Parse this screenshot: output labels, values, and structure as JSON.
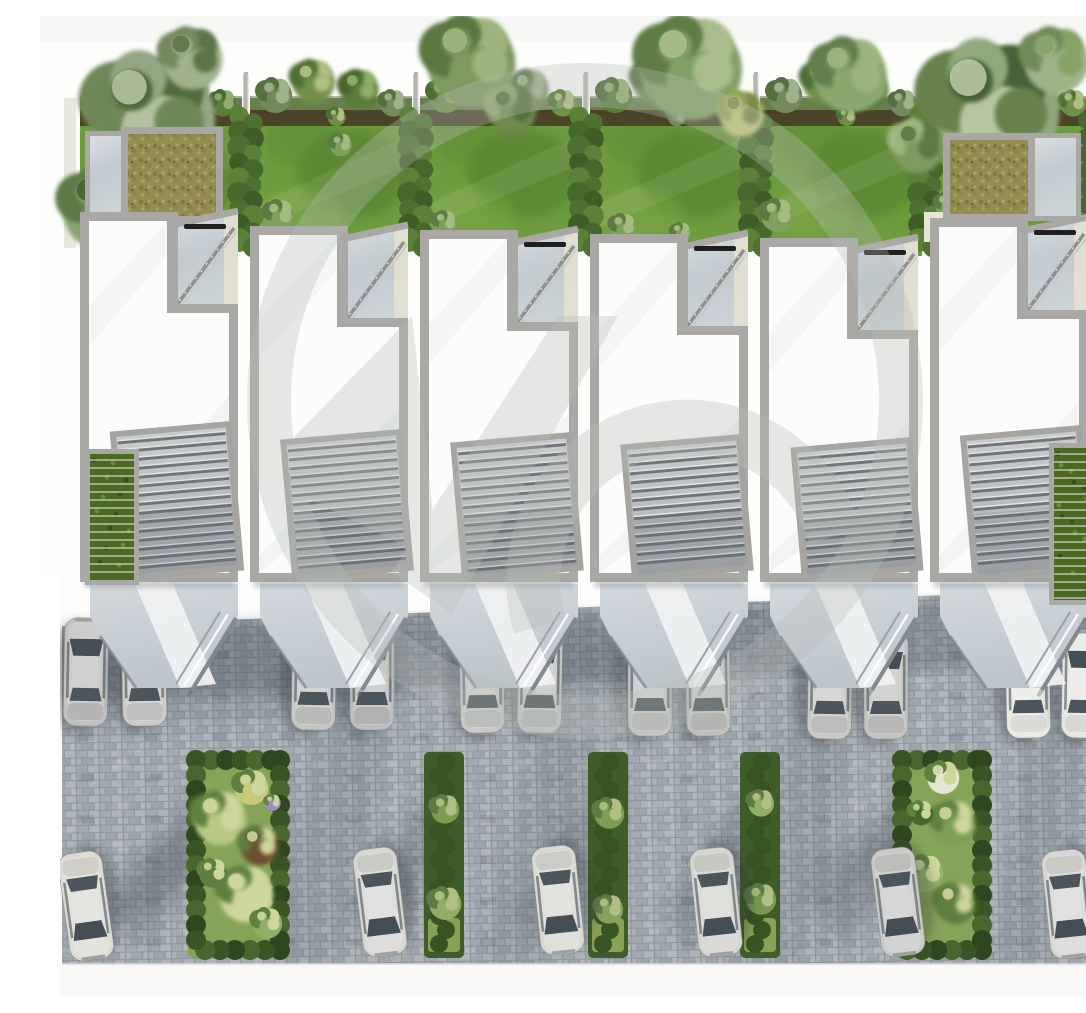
{
  "scene": {
    "description": "Aerial top-down 3D architectural rendering of six modern terraced townhouses with private rear gardens and hedges at the top, white roofs with roof terraces and louvered pergolas in the middle, and a block-paved parking court with parked cars and planted islands at the bottom; a light gray circular logo watermark overlays the center.",
    "canvas": {
      "width": 1086,
      "height": 981,
      "background": "#fdfdfc",
      "top_band": "#f6f7f5",
      "bottom_band": "#f8f8f6"
    },
    "palette": {
      "lawn": "#6d9b3d",
      "lawn_dark": "#4f7a2c",
      "lawn_light": "#84ad4d",
      "hedge_dark": "#3f5e27",
      "hedge_mid": "#4e7030",
      "hedge_light": "#5b8038",
      "mulch": "#463524",
      "top_wall": "#63635e",
      "parapet": "#a9a8a5",
      "roof_white": "#fbfcfc",
      "roof_shade": "#e8ebe9",
      "louver_panel": "#c3c6c7",
      "louver_slat": "#70757a",
      "louver_frame": "#a5a4a1",
      "marble_light": "#d9dee1",
      "marble_mid": "#c2cacf",
      "court": "#cbd2d7",
      "walkway": "#eef0f1",
      "paver": "#a9b0b6",
      "paver_dark": "#9ca4ac",
      "paver_light": "#b2b8be",
      "paver_joint": "#8f969d",
      "shade": "#323b46",
      "beige": "#e8e5d4",
      "beige_wall": "#e3e0d0",
      "pale_wall": "#e9e8de",
      "sedum_base": "#9b9055",
      "sedum_dark": "#7a7c42",
      "sedum_light": "#b4aa67",
      "green_wall": "#4a6a22",
      "glass_dark": "#454e54",
      "glass_rear": "#4c555b",
      "watermark": "#b9beb8"
    },
    "units": {
      "count": 6,
      "x_starts": [
        36,
        206,
        376,
        546,
        716,
        886
      ],
      "width": 170,
      "top_offsets": [
        0,
        14,
        18,
        22,
        26,
        6
      ],
      "roof_top": 196,
      "roof_bottom": 566,
      "vent_units": [
        0,
        2,
        3,
        4,
        5
      ]
    },
    "gardens": {
      "top": 82,
      "fence_xs": [
        206,
        376,
        546,
        716,
        886
      ],
      "right_wall_x": 1052,
      "shrub_spots": [
        [
          28,
          78,
          17
        ],
        [
          66,
          64,
          21
        ],
        [
          112,
          72,
          19
        ],
        [
          146,
          86,
          13
        ],
        [
          90,
          100,
          9
        ]
      ],
      "inner_bushes": [
        [
          238,
          198,
          15
        ],
        [
          300,
          128,
          11
        ],
        [
          404,
          206,
          12
        ],
        [
          582,
          210,
          13
        ],
        [
          640,
          216,
          10
        ],
        [
          736,
          198,
          16
        ],
        [
          906,
          188,
          12
        ]
      ]
    },
    "trees": [
      {
        "x": 108,
        "y": 96,
        "r": 62,
        "c": [
          "#93a683",
          "#6e8758",
          "#4f6a3c",
          "#b3c1a0"
        ]
      },
      {
        "x": 60,
        "y": 190,
        "r": 40,
        "c": [
          "#8ba272",
          "#5d7a44",
          "#42612f"
        ]
      },
      {
        "x": 150,
        "y": 40,
        "r": 30,
        "c": [
          "#9fb18d",
          "#74895c",
          "#5c7547"
        ]
      },
      {
        "x": 428,
        "y": 42,
        "r": 44,
        "c": [
          "#7e9a60",
          "#5a7840",
          "#9eb47e"
        ]
      },
      {
        "x": 470,
        "y": 92,
        "r": 24,
        "c": [
          "#6d8a50",
          "#8fa871",
          "#546e3c"
        ]
      },
      {
        "x": 648,
        "y": 48,
        "r": 50,
        "c": [
          "#83a066",
          "#5f7d45",
          "#a9bd8c"
        ]
      },
      {
        "x": 700,
        "y": 96,
        "r": 22,
        "c": [
          "#c3c97a",
          "#97a45c",
          "#7c8a46"
        ]
      },
      {
        "x": 808,
        "y": 56,
        "r": 36,
        "c": [
          "#8aa86e",
          "#647f4e",
          "#9eb47e"
        ]
      },
      {
        "x": 948,
        "y": 88,
        "r": 66,
        "c": [
          "#90a87d",
          "#67814e",
          "#47623a",
          "#b7c6a2"
        ]
      },
      {
        "x": 1014,
        "y": 42,
        "r": 32,
        "c": [
          "#9eb488",
          "#708b58",
          "#86a368"
        ]
      },
      {
        "x": 876,
        "y": 128,
        "r": 26,
        "c": [
          "#7d9a60",
          "#9db77f",
          "#5c7a42"
        ]
      },
      {
        "x": 996,
        "y": 150,
        "r": 22,
        "c": [
          "#86a368",
          "#aabc84",
          "#647f4e"
        ]
      }
    ],
    "roof_structures": {
      "sedum_boxes": [
        {
          "x": 88,
          "y": 118,
          "w": 88,
          "h": 82
        },
        {
          "x": 910,
          "y": 124,
          "w": 78,
          "h": 74
        }
      ],
      "paved_roofs": [
        {
          "x": 50,
          "y": 120,
          "w": 40,
          "h": 80
        },
        {
          "x": 990,
          "y": 122,
          "w": 46,
          "h": 78
        }
      ],
      "beige_walls": [
        {
          "x": 56,
          "y": 198,
          "w": 122,
          "h": 26
        },
        {
          "x": 884,
          "y": 196,
          "w": 28,
          "h": 30
        }
      ],
      "green_wall_strips": [
        {
          "x": 50,
          "y": 438,
          "w": 44,
          "h": 126
        },
        {
          "x": 1014,
          "y": 432,
          "w": 46,
          "h": 152
        }
      ]
    },
    "parking": {
      "surface": [
        [
          22,
          610
        ],
        [
          340,
          598
        ],
        [
          1060,
          574
        ],
        [
          1060,
          948
        ],
        [
          22,
          948
        ]
      ],
      "shade_band": [
        [
          22,
          612
        ],
        [
          1060,
          578
        ],
        [
          1060,
          648
        ],
        [
          22,
          684
        ]
      ],
      "sun_bands": [
        [
          [
            300,
            612
          ],
          [
            228,
            948
          ],
          [
            300,
            948
          ],
          [
            374,
            612
          ]
        ],
        [
          [
            520,
            612
          ],
          [
            440,
            948
          ],
          [
            506,
            948
          ],
          [
            588,
            612
          ]
        ],
        [
          [
            760,
            640
          ],
          [
            690,
            948
          ],
          [
            762,
            948
          ],
          [
            828,
            640
          ]
        ],
        [
          [
            1000,
            660
          ],
          [
            948,
            948
          ],
          [
            1012,
            948
          ],
          [
            1056,
            660
          ]
        ]
      ],
      "front_cars": [
        {
          "x": 46,
          "y": 656,
          "rot": 1,
          "c": "#c0c1c0"
        },
        {
          "x": 104,
          "y": 656,
          "rot": -1,
          "c": "#cbccca"
        },
        {
          "x": 274,
          "y": 660,
          "rot": 1,
          "c": "#c6c7c5"
        },
        {
          "x": 332,
          "y": 660,
          "rot": 0,
          "c": "#bcbdbc"
        },
        {
          "x": 442,
          "y": 663,
          "rot": -1,
          "c": "#c9cac8"
        },
        {
          "x": 500,
          "y": 663,
          "rot": 1,
          "c": "#c2c3c1"
        },
        {
          "x": 610,
          "y": 666,
          "rot": 0,
          "c": "#c6c7c5"
        },
        {
          "x": 668,
          "y": 666,
          "rot": -1,
          "c": "#bfc0be"
        },
        {
          "x": 790,
          "y": 669,
          "rot": 1,
          "c": "#c9cac8"
        },
        {
          "x": 846,
          "y": 669,
          "rot": 0,
          "c": "#c3c4c2"
        },
        {
          "x": 988,
          "y": 668,
          "rot": -1,
          "c": "#e9eae6"
        },
        {
          "x": 1044,
          "y": 668,
          "rot": 1,
          "c": "#e6e7e3"
        }
      ],
      "street_cars": [
        {
          "x": 46,
          "y": 890,
          "rot": 172,
          "c": "#dddcd4"
        },
        {
          "x": 340,
          "y": 886,
          "rot": 173,
          "c": "#d6d7d3"
        },
        {
          "x": 518,
          "y": 884,
          "rot": 174,
          "c": "#d8d9d5"
        },
        {
          "x": 676,
          "y": 886,
          "rot": 174,
          "c": "#d4d5d1"
        },
        {
          "x": 858,
          "y": 886,
          "rot": 173,
          "c": "#c9cac8"
        },
        {
          "x": 1028,
          "y": 888,
          "rot": 174,
          "c": "#d6d7d3"
        }
      ]
    },
    "islands": {
      "wide": [
        {
          "x": 148,
          "y": 736,
          "w": 100,
          "h": 206,
          "bushes": [
            [
              30,
              64,
              26,
              "#b7c982"
            ],
            [
              62,
              34,
              17,
              "#c6cb7c"
            ],
            [
              70,
              92,
              19,
              "#6d4f33"
            ],
            [
              56,
              140,
              27,
              "#cdd69b"
            ],
            [
              24,
              120,
              14,
              "#5d7f42"
            ],
            [
              78,
              170,
              15,
              "#8fae66"
            ],
            [
              84,
              50,
              8,
              "#9b8cc4"
            ]
          ]
        },
        {
          "x": 854,
          "y": 736,
          "w": 96,
          "h": 206,
          "bushes": [
            [
              48,
              24,
              16,
              "#e3e7d2"
            ],
            [
              58,
              70,
              22,
              "#7da055"
            ],
            [
              30,
              120,
              18,
              "#93b069"
            ],
            [
              60,
              150,
              20,
              "#5f8140"
            ],
            [
              26,
              60,
              12,
              "#46682c"
            ]
          ]
        }
      ],
      "strips": [
        {
          "x": 384,
          "y": 736,
          "w": 40,
          "h": 206,
          "trees": [
            [
              56,
              14,
              "#7d9d55"
            ],
            [
              150,
              16,
              "#91ad67"
            ]
          ]
        },
        {
          "x": 548,
          "y": 736,
          "w": 40,
          "h": 206,
          "trees": [
            [
              60,
              15,
              "#7d9d55"
            ],
            [
              156,
              14,
              "#86a35e"
            ]
          ]
        },
        {
          "x": 700,
          "y": 736,
          "w": 40,
          "h": 206,
          "trees": [
            [
              50,
              13,
              "#8fae66"
            ],
            [
              146,
              15,
              "#77984f"
            ]
          ]
        }
      ]
    },
    "watermark": {
      "color": "#b9beb8",
      "opacity": 0.32,
      "circle": {
        "cx": 545,
        "cy": 385,
        "r": 316,
        "stroke_width": 44
      },
      "slash": [
        [
          352,
          556
        ],
        [
          518,
          300
        ],
        [
          578,
          300
        ],
        [
          412,
          598
        ]
      ],
      "wedge": [
        [
          218,
          458
        ],
        [
          372,
          300
        ],
        [
          398,
          546
        ]
      ],
      "bowl": {
        "path": "M 500,610 A 150 150 0 1 1 795,520",
        "stroke_width": 54
      }
    }
  }
}
